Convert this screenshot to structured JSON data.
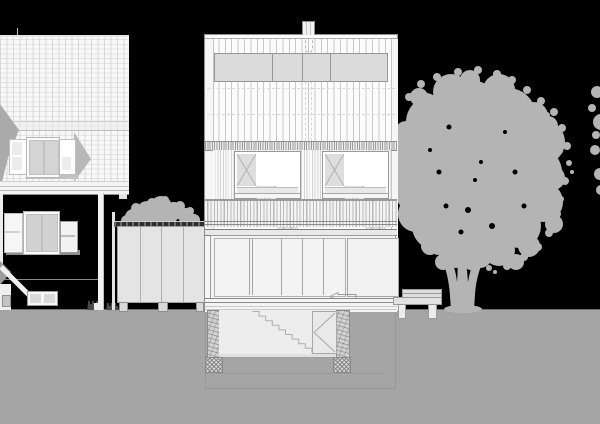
{
  "meta": {
    "description": "Black-background architectural street elevation: existing gabled house (left), new three-storey infill building with basement section (centre), garden shed, bench and large deciduous tree (right).",
    "drawing_type": "building-elevation-section"
  },
  "palette": {
    "bg": "#000000",
    "ground": "#a5a5a5",
    "ground_line": "#6f6f6f",
    "veg": "#b4b4b4",
    "veg_dark": "#4a4a4a",
    "paper": "#f8f8f8",
    "paper2": "#fcfcfc",
    "line": "#9a9a9a",
    "line_dark": "#8a8a8a",
    "line_faint": "#c9c9c9",
    "panel_gray": "#dbdbdb",
    "sash_gray": "#d4d4d4",
    "glass": "#f3f3f3",
    "room": "#ededed",
    "bench": "#e2e2e2",
    "shed": "#e4e4e4",
    "shadow_gray": "#b0b0b0"
  },
  "vegetation": {
    "tree": {
      "blobs": [
        [
          470,
          112,
          32
        ],
        [
          432,
          122,
          26
        ],
        [
          508,
          116,
          28
        ],
        [
          543,
          142,
          22
        ],
        [
          416,
          152,
          27
        ],
        [
          456,
          152,
          33
        ],
        [
          500,
          152,
          31
        ],
        [
          538,
          172,
          24
        ],
        [
          421,
          190,
          26
        ],
        [
          465,
          192,
          32
        ],
        [
          509,
          196,
          28
        ],
        [
          543,
          202,
          20
        ],
        [
          436,
          226,
          24
        ],
        [
          480,
          228,
          28
        ],
        [
          519,
          226,
          22
        ],
        [
          456,
          250,
          18
        ],
        [
          499,
          250,
          16
        ],
        [
          416,
          214,
          18
        ],
        [
          405,
          172,
          14
        ],
        [
          451,
          92,
          18
        ],
        [
          499,
          90,
          16
        ],
        [
          426,
          106,
          13
        ],
        [
          534,
          116,
          14
        ],
        [
          480,
          256,
          12
        ],
        [
          529,
          246,
          11
        ],
        [
          406,
          132,
          11
        ],
        [
          553,
          178,
          12
        ],
        [
          470,
          80,
          10
        ],
        [
          419,
          97,
          9
        ],
        [
          548,
          126,
          10
        ],
        [
          398,
          158,
          8
        ],
        [
          554,
          224,
          9
        ],
        [
          516,
          262,
          8
        ],
        [
          430,
          246,
          9
        ],
        [
          443,
          262,
          8
        ]
      ],
      "fringe": [
        [
          397,
          143,
          4
        ],
        [
          395,
          170,
          3
        ],
        [
          399,
          187,
          4
        ],
        [
          406,
          200,
          3
        ],
        [
          409,
          97,
          4
        ],
        [
          421,
          84,
          4
        ],
        [
          437,
          77,
          4
        ],
        [
          458,
          72,
          4
        ],
        [
          478,
          70,
          4
        ],
        [
          497,
          74,
          4
        ],
        [
          512,
          80,
          4
        ],
        [
          527,
          90,
          4
        ],
        [
          541,
          101,
          4
        ],
        [
          554,
          112,
          4
        ],
        [
          562,
          128,
          4
        ],
        [
          567,
          146,
          4
        ],
        [
          569,
          163,
          3
        ],
        [
          565,
          181,
          4
        ],
        [
          561,
          199,
          3
        ],
        [
          557,
          214,
          4
        ],
        [
          549,
          233,
          4
        ],
        [
          538,
          247,
          4
        ],
        [
          524,
          257,
          4
        ],
        [
          507,
          266,
          4
        ],
        [
          489,
          268,
          3
        ],
        [
          470,
          266,
          4
        ],
        [
          452,
          260,
          3
        ],
        [
          437,
          252,
          3
        ],
        [
          425,
          236,
          4
        ],
        [
          412,
          224,
          3
        ],
        [
          572,
          172,
          2
        ],
        [
          560,
          151,
          3
        ],
        [
          547,
          115,
          3
        ],
        [
          530,
          250,
          3
        ],
        [
          495,
          272,
          2
        ]
      ],
      "holes": [
        [
          468,
          210,
          3
        ],
        [
          492,
          226,
          3
        ],
        [
          446,
          206,
          2.5
        ],
        [
          515,
          172,
          2.5
        ],
        [
          481,
          162,
          2
        ],
        [
          439,
          172,
          2.5
        ],
        [
          524,
          206,
          2.5
        ],
        [
          461,
          232,
          2.5
        ],
        [
          449,
          127,
          2.5
        ],
        [
          505,
          132,
          2
        ],
        [
          475,
          180,
          2
        ],
        [
          430,
          150,
          2
        ]
      ],
      "trunk_path": "M451,310 L450,296 C449,281 446,268 441,258 L448,252 C453,262 456,272 457,282 C458,270 458,258 456,246 L464,243 C466,257 467,270 468,282 C470,270 474,258 479,250 L486,255 C480,266 476,280 475,294 L474,310 Z",
      "root_flare": [
        463,
        309,
        19,
        4
      ]
    },
    "edge_wisps": [
      [
        597,
        92,
        6
      ],
      [
        601,
        122,
        8
      ],
      [
        595,
        150,
        5
      ],
      [
        600,
        174,
        6
      ],
      [
        592,
        108,
        4
      ],
      [
        601,
        190,
        5
      ],
      [
        596,
        135,
        4
      ]
    ],
    "shed_bush": [
      [
        133,
        217,
        8
      ],
      [
        147,
        211,
        10
      ],
      [
        161,
        207,
        11
      ],
      [
        174,
        211,
        9
      ],
      [
        186,
        216,
        8
      ],
      [
        194,
        220,
        6
      ],
      [
        127,
        221,
        6
      ],
      [
        155,
        218,
        10
      ],
      [
        168,
        217,
        9
      ],
      [
        141,
        219,
        9
      ],
      [
        180,
        206,
        5
      ],
      [
        152,
        203,
        5
      ],
      [
        165,
        200,
        4
      ],
      [
        136,
        208,
        5
      ],
      [
        190,
        211,
        4
      ]
    ],
    "grass_tufts": [
      {
        "x": 88,
        "w": 12,
        "h": 9
      },
      {
        "x": 107,
        "w": 11,
        "h": 7
      },
      {
        "x": 343,
        "w": 10,
        "h": 8
      }
    ]
  },
  "basement": {
    "stair": {
      "x": 252.5,
      "y": 311.5,
      "steps": 9,
      "dx": 6.6,
      "dy": 4.6
    }
  },
  "ground_floor": {
    "deck_line_ys": [
      266,
      269,
      272,
      275,
      278,
      281,
      284
    ],
    "deck_x1": 212,
    "deck_x2": 337
  }
}
